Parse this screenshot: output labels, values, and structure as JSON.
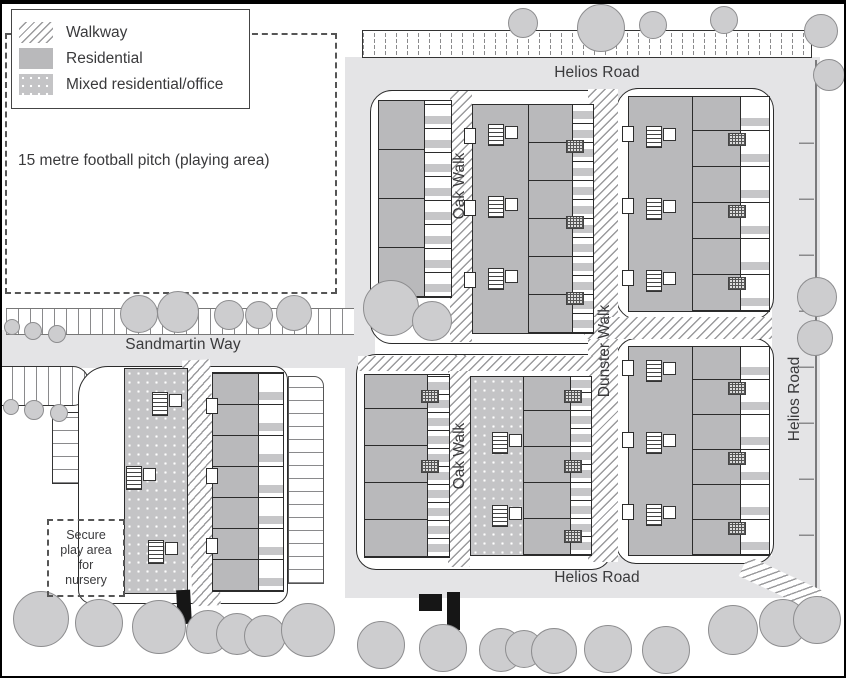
{
  "colors": {
    "road": "#e4e4e6",
    "residential": "#b9b9bb",
    "mixed": "#c4c4c6",
    "tree_fill": "#cdcdcf",
    "tree_stroke": "#8d8d8f",
    "outline": "#2b2b2b",
    "text": "#3a3a3c",
    "hatch": "#9a9a9c"
  },
  "legend": {
    "items": [
      {
        "label": "Walkway",
        "swatch": "walkway-hatch"
      },
      {
        "label": "Residential",
        "swatch": "residential-gray"
      },
      {
        "label": "Mixed residential/office",
        "swatch": "mixed-dotted"
      }
    ]
  },
  "labels": {
    "football_pitch": "15 metre football pitch (playing area)",
    "helios_road_top": "Helios Road",
    "helios_road_right": "Helios Road",
    "helios_road_bottom": "Helios Road",
    "sandmartin_way": "Sandmartin Way",
    "oak_walk_upper": "Oak Walk",
    "oak_walk_lower": "Oak Walk",
    "dunster_walk": "Dunster Walk",
    "secure_play_lines": [
      "Secure",
      "play area",
      "for",
      "nursery"
    ]
  },
  "map": {
    "trees": [
      [
        522,
        22,
        14
      ],
      [
        600,
        27,
        23
      ],
      [
        652,
        24,
        13
      ],
      [
        723,
        19,
        13
      ],
      [
        820,
        30,
        16
      ],
      [
        828,
        74,
        15
      ],
      [
        138,
        313,
        18
      ],
      [
        177,
        311,
        20
      ],
      [
        228,
        314,
        14
      ],
      [
        258,
        314,
        13
      ],
      [
        293,
        312,
        17
      ],
      [
        390,
        307,
        27
      ],
      [
        431,
        320,
        19
      ],
      [
        816,
        296,
        19
      ],
      [
        814,
        337,
        17
      ],
      [
        40,
        618,
        27
      ],
      [
        98,
        622,
        23
      ],
      [
        158,
        626,
        26
      ],
      [
        207,
        631,
        21
      ],
      [
        236,
        633,
        20
      ],
      [
        264,
        635,
        20
      ],
      [
        307,
        629,
        26
      ],
      [
        380,
        644,
        23
      ],
      [
        442,
        647,
        23
      ],
      [
        500,
        649,
        21
      ],
      [
        523,
        648,
        18
      ],
      [
        553,
        650,
        22
      ],
      [
        607,
        648,
        23
      ],
      [
        665,
        649,
        23
      ],
      [
        732,
        629,
        24
      ],
      [
        782,
        622,
        23
      ],
      [
        816,
        619,
        23
      ]
    ],
    "bushes": [
      [
        11,
        326,
        7
      ],
      [
        32,
        330,
        8
      ],
      [
        56,
        333,
        8
      ],
      [
        10,
        406,
        7
      ],
      [
        33,
        409,
        9
      ],
      [
        58,
        412,
        8
      ]
    ]
  }
}
